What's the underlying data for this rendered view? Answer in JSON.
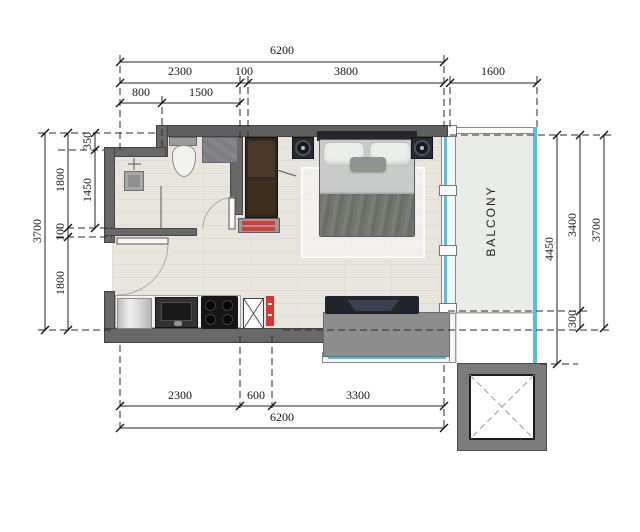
{
  "plan": {
    "balcony_label": "BALCONY"
  },
  "dims": {
    "top_total": "6200",
    "top_seg1": "2300",
    "top_seg2": "100",
    "top_seg3": "3800",
    "top_balcony": "1600",
    "top_sub1": "800",
    "top_sub2": "1500",
    "left_total": "3700",
    "left_seg1": "1800",
    "left_seg2": "100",
    "left_seg3": "1800",
    "left_sub1": "350",
    "left_sub2": "1450",
    "right_outer": "4450",
    "right_seg1": "3400",
    "right_seg2": "300",
    "right_total": "3700",
    "bottom_seg1": "2300",
    "bottom_seg2": "600",
    "bottom_seg3": "3300",
    "bottom_total": "6200"
  },
  "colors": {
    "glazing_cyan": "#4fc3dc",
    "wall_gray": "#686868",
    "riser_red": "#d8362f",
    "dim_line": "#222222",
    "floor_wood": "#e8e5de",
    "balcony_floor": "#eaece9",
    "wardrobe_brown": "#34261b"
  }
}
